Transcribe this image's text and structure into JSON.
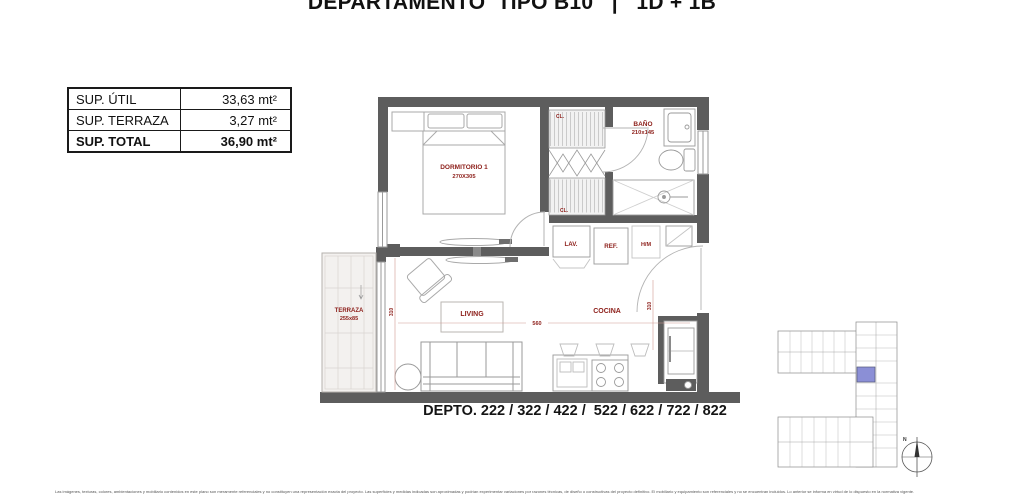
{
  "title": "DEPARTAMENTO  TIPO B10   |   1D + 1B",
  "area_table": {
    "rows": [
      {
        "label": "SUP. ÚTIL",
        "value": "33,63 mt²"
      },
      {
        "label": "SUP. TERRAZA",
        "value": "3,27 mt²"
      },
      {
        "label": "SUP. TOTAL",
        "value": "36,90 mt²"
      }
    ]
  },
  "plan": {
    "rooms": {
      "dormitorio": {
        "label": "DORMITORIO 1",
        "dims": "270X305"
      },
      "bano": {
        "label": "BAÑO",
        "dims": "210x145"
      },
      "terraza": {
        "label": "TERRAZA",
        "dims": "255x85"
      },
      "living": {
        "label": "LIVING"
      },
      "cocina": {
        "label": "COCINA"
      }
    },
    "fixtures": {
      "lav": "LAV.",
      "ref": "REF.",
      "hm": "H/M",
      "cl_top": "CL.",
      "cl_bottom": "CL."
    },
    "dimensions": {
      "living_width": "560",
      "living_depth": "310",
      "cocina_depth": "310"
    }
  },
  "depto_line": "DEPTO. 222 / 322 / 422 /  522 / 622 / 722 / 822",
  "keyplan": {
    "north_label": "N",
    "highlight_color": "#8b8fd6"
  },
  "colors": {
    "label_red": "#8e211c",
    "wall_gray": "#5d5d5d",
    "terraza_fill": "#f3f1ef"
  },
  "disclaimer": "Las imágenes, texturas, colores, ambientaciones y mobiliario contenidos en este plano son meramente referenciales y no constituyen una representación exacta del proyecto. Las superficies y medidas indicadas son aproximadas y podrían experimentar variaciones por razones técnicas, de diseño o constructivas del proyecto definitivo. El mobiliario y equipamiento son referenciales y no se encuentran incluidos. Lo anterior se informa en virtud de lo dispuesto en la normativa vigente."
}
